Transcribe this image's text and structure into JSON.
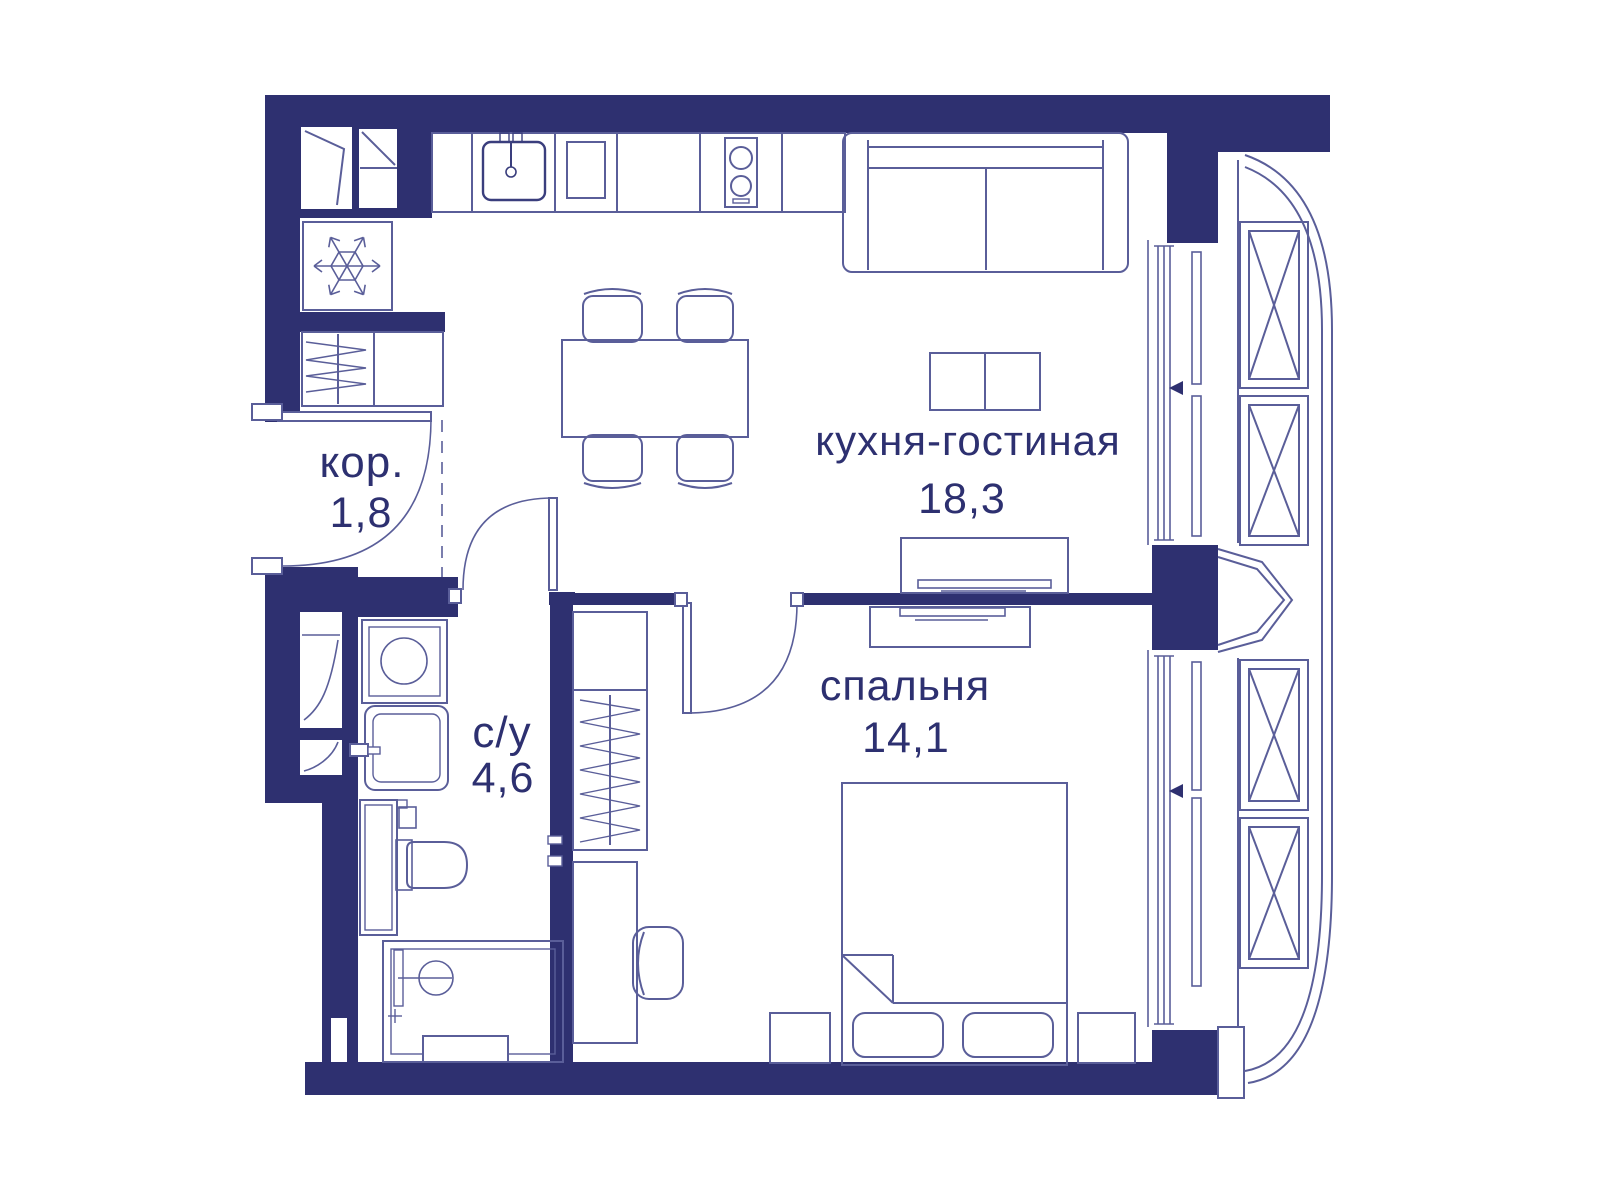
{
  "floorplan": {
    "rooms": [
      {
        "name": "кухня-гостиная",
        "area": "18,3"
      },
      {
        "name": "спальня",
        "area": "14,1"
      },
      {
        "name": "кор.",
        "area": "1,8"
      },
      {
        "name": "с/у",
        "area": "4,6"
      }
    ],
    "colors": {
      "wall": "#2e3070",
      "furniture_line": "#5a5e99",
      "label_text": "#2d3070",
      "background": "#ffffff"
    },
    "icons": [
      {
        "name": "snowflake-icon",
        "shape": "snowflake"
      },
      {
        "name": "window-opening-arrow-icon",
        "shape": "triangle-left"
      }
    ]
  }
}
